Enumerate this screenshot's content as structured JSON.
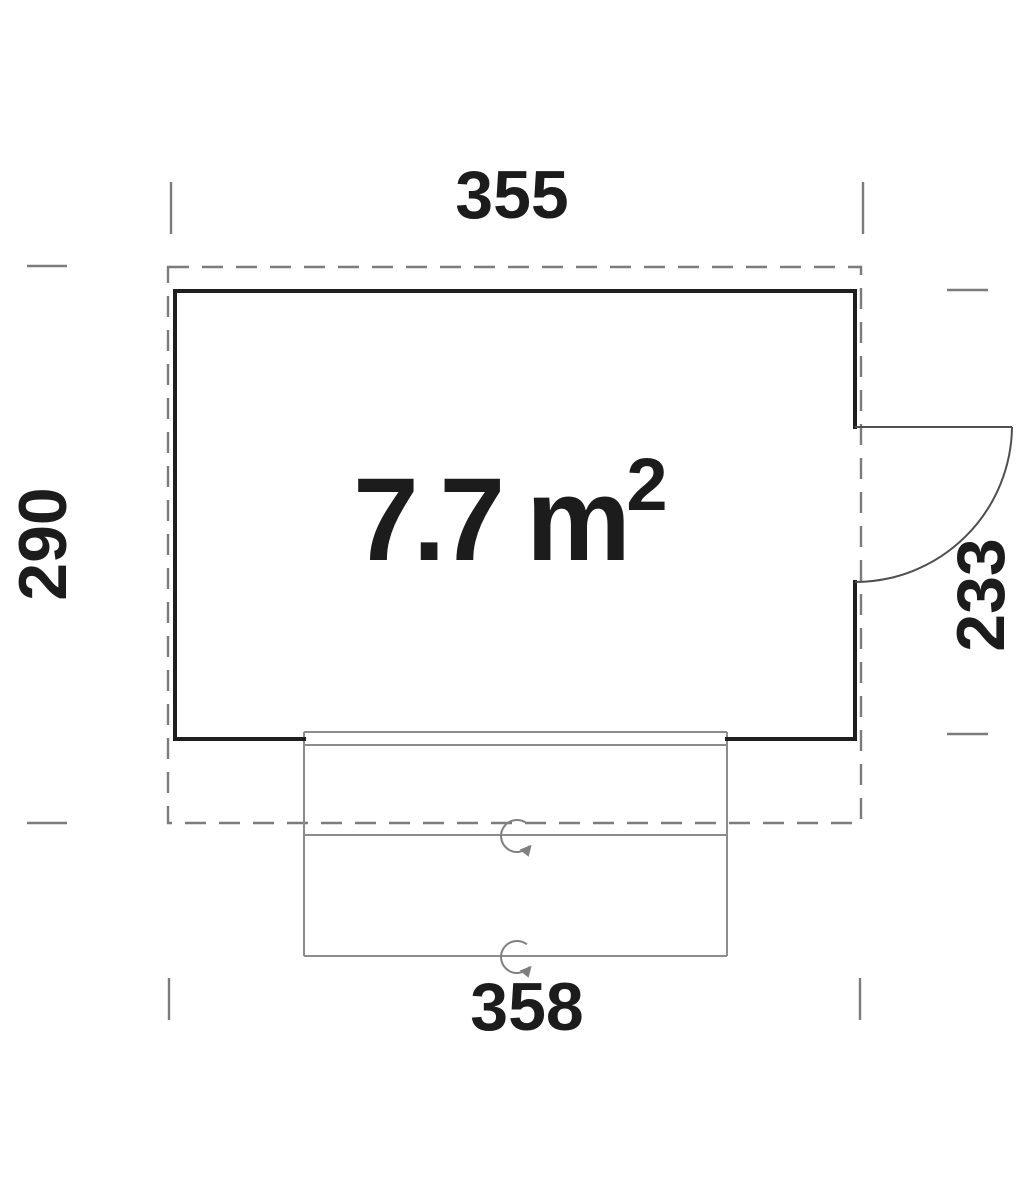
{
  "colors": {
    "background": "#ffffff",
    "wall": "#1f1f1f",
    "roof_outline": "#7c7c7c",
    "terrace": "#8c8c8c",
    "door": "#4f4f4f",
    "symbol": "#7f7f7f",
    "ticks": "#7c7c7c",
    "text": "#1c1c1c"
  },
  "plan": {
    "area_label": {
      "text": "7.7 m",
      "superscript": "2"
    },
    "dimensions": {
      "top": "355",
      "left": "290",
      "right": "233",
      "bottom": "358"
    },
    "symbols": {
      "terrace_marker_icon": "circular-arrow",
      "marker_count": "2"
    }
  }
}
